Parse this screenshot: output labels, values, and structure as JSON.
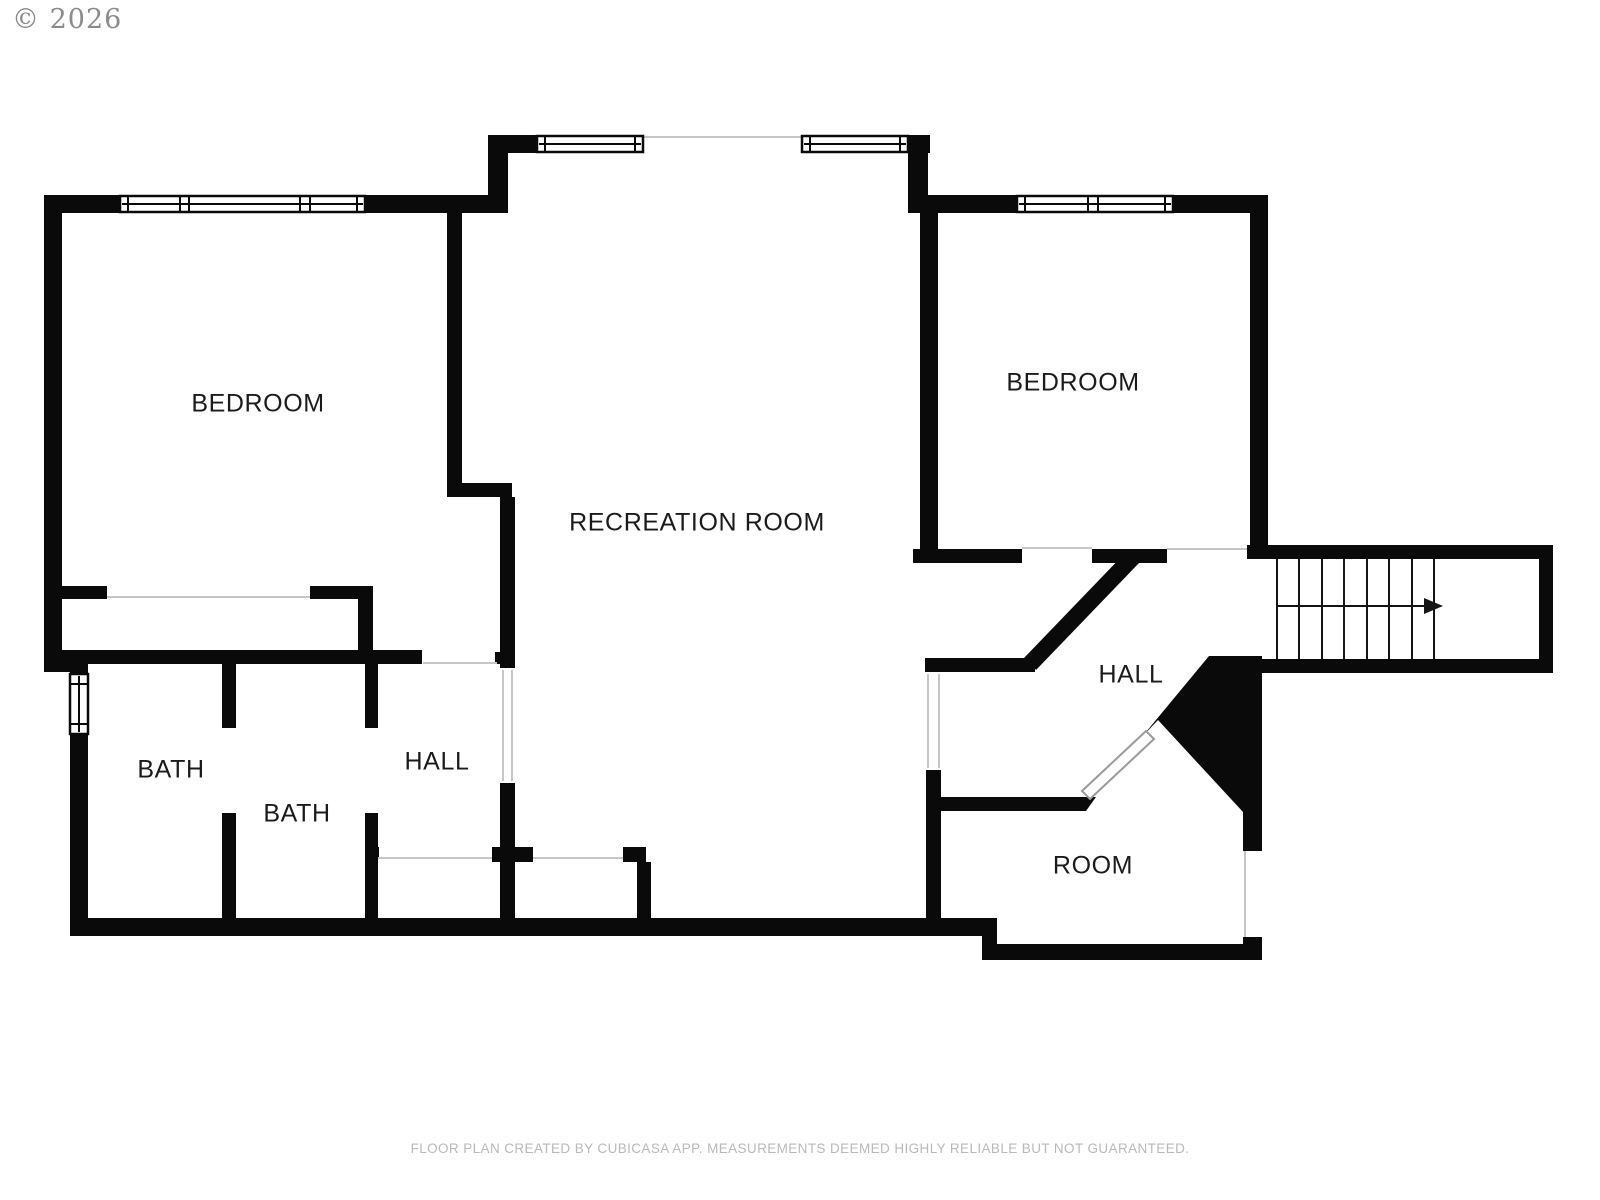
{
  "meta": {
    "copyright": "© 2026",
    "disclaimer": "FLOOR PLAN CREATED BY CUBICASA APP. MEASUREMENTS DEEMED HIGHLY RELIABLE BUT NOT GUARANTEED."
  },
  "floor_plan": {
    "rooms": [
      {
        "id": "bedroom-left",
        "label": "BEDROOM"
      },
      {
        "id": "recreation-room",
        "label": "RECREATION ROOM"
      },
      {
        "id": "bedroom-right",
        "label": "BEDROOM"
      },
      {
        "id": "bath-1",
        "label": "BATH"
      },
      {
        "id": "bath-2",
        "label": "BATH"
      },
      {
        "id": "hall-left",
        "label": "HALL"
      },
      {
        "id": "hall-right",
        "label": "HALL"
      },
      {
        "id": "room",
        "label": "ROOM"
      }
    ],
    "stairs": {
      "tread_count": 8,
      "arrow_direction": "right"
    },
    "window_count": 5,
    "colors": {
      "wall": "#0a0a0a",
      "background": "#ffffff",
      "label_text": "#1b1b1b",
      "opening_line": "#c6c6c6",
      "copyright_text": "#8b8b8b",
      "disclaimer_text": "#b9b9b9"
    }
  }
}
